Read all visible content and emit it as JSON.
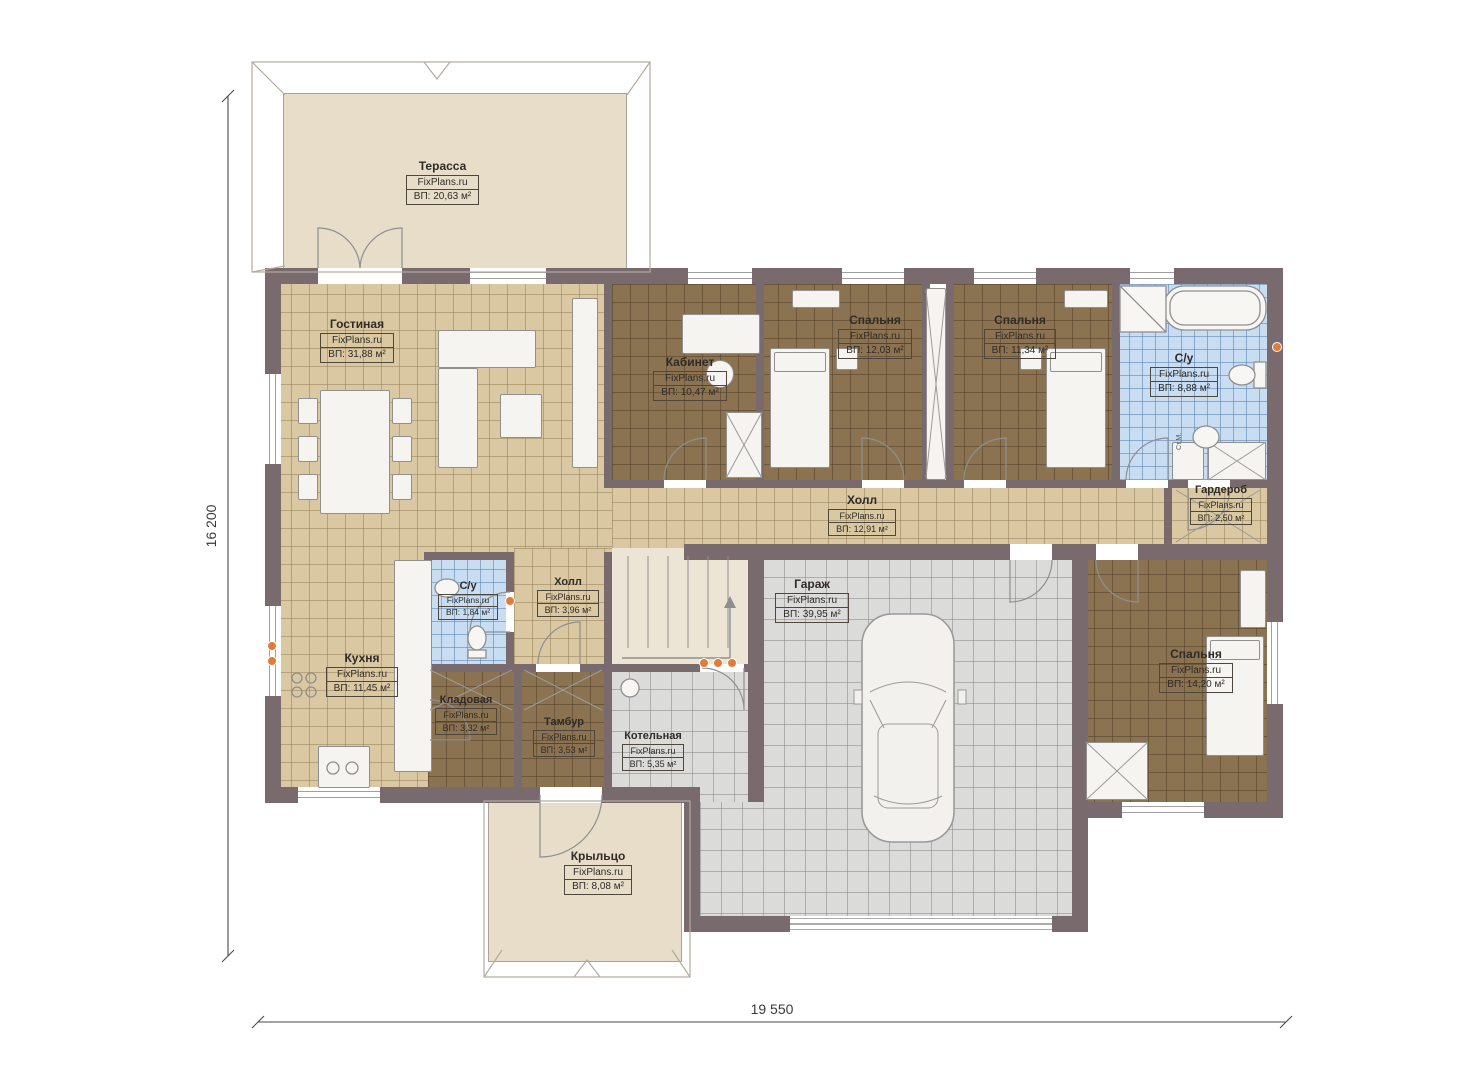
{
  "watermark": "FixPlans.ru",
  "rooms": {
    "terrace": {
      "name": "Терасса",
      "area": "ВП: 20,63 м²"
    },
    "living": {
      "name": "Гостиная",
      "area": "ВП: 31,88 м²"
    },
    "office": {
      "name": "Кабинет",
      "area": "ВП: 10,47 м²"
    },
    "bedroom1": {
      "name": "Спальня",
      "area": "ВП: 12,03 м²"
    },
    "bedroom2": {
      "name": "Спальня",
      "area": "ВП: 11,34 м²"
    },
    "bathroom": {
      "name": "С/у",
      "area": "ВП: 8,88 м²"
    },
    "wardrobe": {
      "name": "Гардероб",
      "area": "ВП: 2,50 м²"
    },
    "hall": {
      "name": "Холл",
      "area": "ВП: 12,91 м²"
    },
    "hall2": {
      "name": "Холл",
      "area": "ВП: 3,96 м²"
    },
    "wc": {
      "name": "С/у",
      "area": "ВП: 1,84 м²"
    },
    "kitchen": {
      "name": "Кухня",
      "area": "ВП: 11,45 м²"
    },
    "storage": {
      "name": "Кладовая",
      "area": "ВП: 3,32 м²"
    },
    "vestibule": {
      "name": "Тамбур",
      "area": "ВП: 3,53 м²"
    },
    "boiler": {
      "name": "Котельная",
      "area": "ВП: 5,35 м²"
    },
    "garage": {
      "name": "Гараж",
      "area": "ВП: 39,95 м²"
    },
    "bedroom3": {
      "name": "Спальня",
      "area": "ВП: 14,20 м²"
    },
    "porch": {
      "name": "Крыльцо",
      "area": "ВП: 8,08 м²"
    }
  },
  "dimensions": {
    "height": "16 200",
    "width": "19 550"
  },
  "annotations": {
    "washing_machine": "Ст.М."
  },
  "colors": {
    "wall": "#786a6d",
    "floor_beige": "#d9c8a2",
    "floor_brown": "#8b7352",
    "floor_blue": "#c8ddf2",
    "floor_gray": "#dbdbda",
    "terrace": "#e8ddc9",
    "accent_dot": "#e07b39"
  }
}
